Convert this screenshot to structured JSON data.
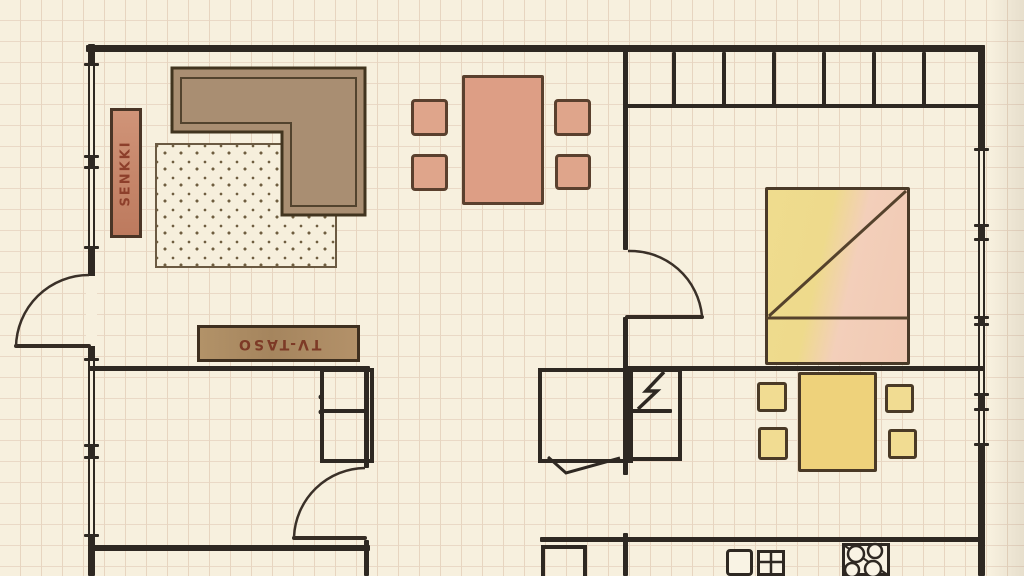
{
  "document": {
    "kind": "hand-drawn apartment floor plan on graph paper",
    "paper_color": "#f7f0de",
    "grid_color": "#e7d5c0",
    "ink_color": "#2e2822"
  },
  "labels": {
    "sideboard": {
      "text": "SENKKI",
      "color": "#8d3f2b",
      "rotation_deg": -90
    },
    "tv_stand": {
      "text": "TV-TASO",
      "color": "#7d3a26",
      "rotation_deg": 180
    }
  },
  "furniture": {
    "sofa": {
      "name": "l-shaped-sofa",
      "color": "#a98e72"
    },
    "rug": {
      "name": "dotted-rug",
      "color": "#f6efdc",
      "dot_color": "#6f5e40"
    },
    "sideboard": {
      "name": "senkki-sideboard",
      "color": "#c8896d"
    },
    "tv_stand": {
      "name": "tv-taso-shelf",
      "color": "#ae8d67"
    },
    "dining_table": {
      "name": "dining-table",
      "color": "#dd9e85",
      "chair_count": 4,
      "chair_color": "#dfa58b"
    },
    "bed": {
      "name": "double-bed",
      "colors": [
        "#eeda8c",
        "#f1c9b3"
      ]
    },
    "kitchen_table": {
      "name": "kitchen-table",
      "color": "#eed27b",
      "chair_count": 4,
      "chair_color": "#f1dc92"
    },
    "wardrobe_row": {
      "name": "wardrobe-row",
      "section_count": 7
    }
  },
  "fixtures": {
    "stove": {
      "name": "stove-4-burners",
      "burner_count": 4
    },
    "sink": {
      "name": "kitchen-sink"
    },
    "electrical": {
      "name": "lightning-bolt-symbol"
    },
    "doors": {
      "count": 3,
      "symbol": "quarter-circle-swing"
    },
    "windows": {
      "symbol": "double-line-with-ticks"
    }
  }
}
